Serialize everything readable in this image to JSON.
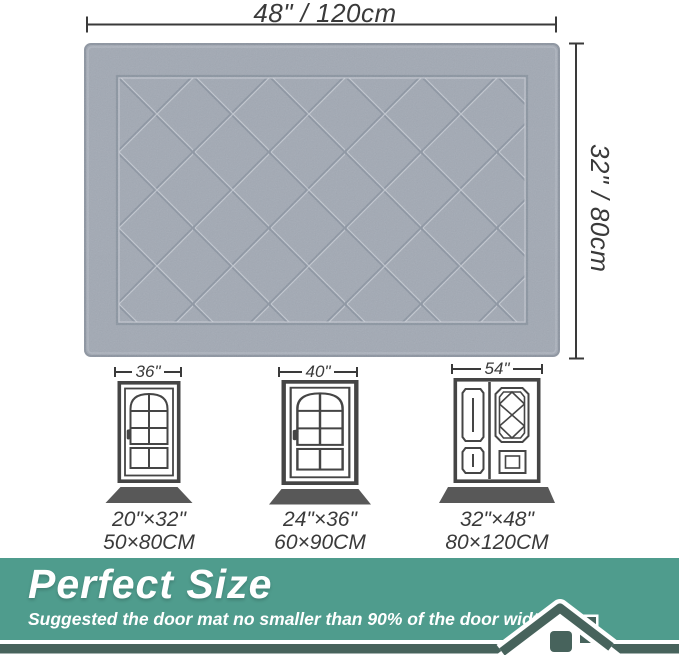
{
  "product_diagram": {
    "width_label": "48\" / 120cm",
    "height_label": "32\" / 80cm"
  },
  "door_examples": [
    {
      "door_width": "36\"",
      "mat_size_inches": "20\"×32\"",
      "mat_size_cm": "50×80CM"
    },
    {
      "door_width": "40\"",
      "mat_size_inches": "24\"×36\"",
      "mat_size_cm": "60×90CM"
    },
    {
      "door_width": "54\"",
      "mat_size_inches": "32\"×48\"",
      "mat_size_cm": "80×120CM"
    }
  ],
  "banner": {
    "title": "Perfect Size",
    "subtitle": "Suggested the door mat no smaller than 90% of the door width.",
    "icon": "house-roof-icon",
    "background_color": "#4f9c8d",
    "dark_accent_color": "#47635c",
    "text_color": "#ffffff"
  },
  "colors": {
    "mat_base": "#a2a9b4",
    "mat_groove": "#8a93a0",
    "dimension_ink": "#3a3a3a",
    "door_line_ink": "#454545",
    "door_mat_fill": "#585858",
    "background": "#ffffff"
  }
}
